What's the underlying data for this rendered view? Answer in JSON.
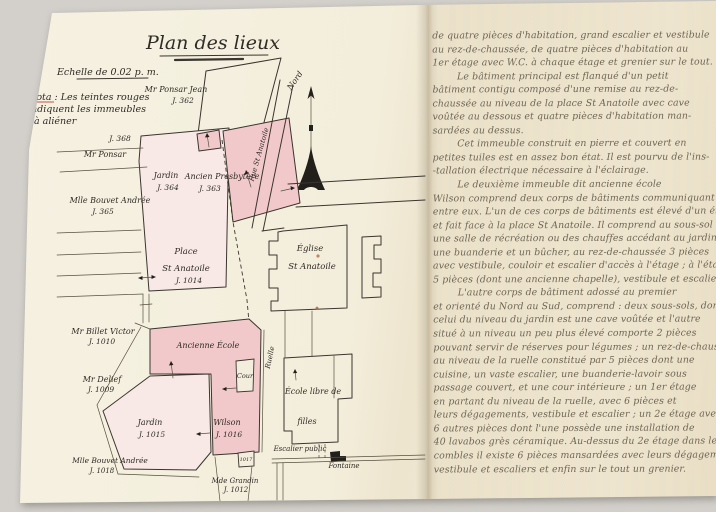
{
  "colors": {
    "background": "#d3d0cb",
    "paper": "#f3eedb",
    "paper_right": "#eee4cd",
    "pink_dark": "#f2c9cb",
    "pink_light": "#f8e9e6",
    "ink": "#3a352e",
    "red_note": "#c2544b",
    "handwriting_ink": "#6e6554"
  },
  "left_page": {
    "title": "Plan des lieux",
    "scale": "Echelle de 0.02 p. m.",
    "nota_line1": "Nota : Les teintes rouges",
    "nota_line2": "indiquent les immeubles",
    "nota_line3": "à aliéner",
    "north": "Nord",
    "labels": {
      "ponsar_jean_1": "Mr Ponsar Jean",
      "ponsar_jean_2": "J. 362",
      "j368": "J. 368",
      "ponsar": "Mr Ponsar",
      "bouvet365_1": "Mlle Bouvet Andrée",
      "bouvet365_2": "J. 365",
      "jardin364_1": "Jardin",
      "jardin364_2": "J. 364",
      "presbytere_1": "Ancien Presbytère",
      "presbytere_2": "J. 363",
      "rue_st_anatoile": "Rue St Anatoile",
      "place_1": "Place",
      "place_2": "St Anatoile",
      "place_3": "J. 1014",
      "eglise_1": "Église",
      "eglise_2": "St Anatoile",
      "billet_1": "Mr Billet Victor",
      "billet_2": "J. 1010",
      "delief_1": "Mr Delief",
      "delief_2": "J. 1009",
      "ancienne_ecole": "Ancienne École",
      "ruelle": "Ruelle",
      "cour": "Cour",
      "jardin1015_1": "Jardin",
      "jardin1015_2": "J. 1015",
      "wilson_1": "Wilson",
      "wilson_2": "J. 1016",
      "bouvet1018_1": "Mlle Bouvet Andrée",
      "bouvet1018_2": "J. 1018",
      "grandin_1": "Mde Grandin",
      "grandin_2": "J. 1012",
      "parcel_1017": "1017",
      "ecole_libre_1": "École libre de",
      "ecole_libre_2": "filles",
      "escalier_public": "Escalier public",
      "fontaine": "Fontaine"
    }
  },
  "right_page": {
    "lines": [
      "de quatre pièces d'habitation, grand escalier et vestibule",
      "au rez-de-chaussée, de quatre pièces d'habitation au",
      "1er étage avec W.C. à chaque étage et grenier sur le tout.",
      "        Le bâtiment principal est flanqué d'un petit",
      "bâtiment contigu composé d'une remise au rez-de-",
      "chaussée au niveau de la place St Anatoile avec cave",
      "voûtée au dessous et quatre pièces d'habitation man-",
      "sardées au dessus.",
      "        Cet immeuble construit en pierre et couvert en",
      "petites tuiles est en assez bon état. Il est pourvu de l'ins-",
      "-tallation électrique nécessaire à l'éclairage.",
      "        Le deuxième immeuble dit ancienne école",
      "Wilson comprend deux corps de bâtiments communiquant",
      "entre eux. L'un de ces corps de bâtiments est élevé d'un étage",
      "et fait face à la place St Anatoile. Il comprend au sous-sol",
      "une salle de récréation ou des chauffes accédant au jardin,",
      "une buanderie et un bûcher, au rez-de-chaussée 3 pièces",
      "avec vestibule, couloir et escalier d'accès à l'étage ; à l'étage",
      "5 pièces (dont une ancienne chapelle), vestibule et escalier.",
      "        L'autre corps de bâtiment adossé au premier",
      "et orienté du Nord au Sud, comprend : deux sous-sols, dont",
      "celui du niveau du jardin est une cave voûtée et l'autre",
      "situé à un niveau un peu plus élevé comporte 2 pièces",
      "pouvant servir de réserves pour légumes ; un rez-de-chaussée",
      "au niveau de la ruelle constitué par 5 pièces dont une",
      "cuisine, un vaste escalier, une buanderie-lavoir sous",
      "passage couvert, et une cour intérieure ; un 1er étage",
      "en partant du niveau de la ruelle, avec 6 pièces et",
      "leurs dégagements, vestibule et escalier ; un 2e étage avec",
      "6 autres pièces dont l'une possède une installation de",
      "40 lavabos grès céramique. Au-dessus du 2e étage dans les",
      "combles il existe 6 pièces mansardées avec leurs dégagements,",
      "vestibule et escaliers et enfin sur le tout un grenier."
    ]
  }
}
